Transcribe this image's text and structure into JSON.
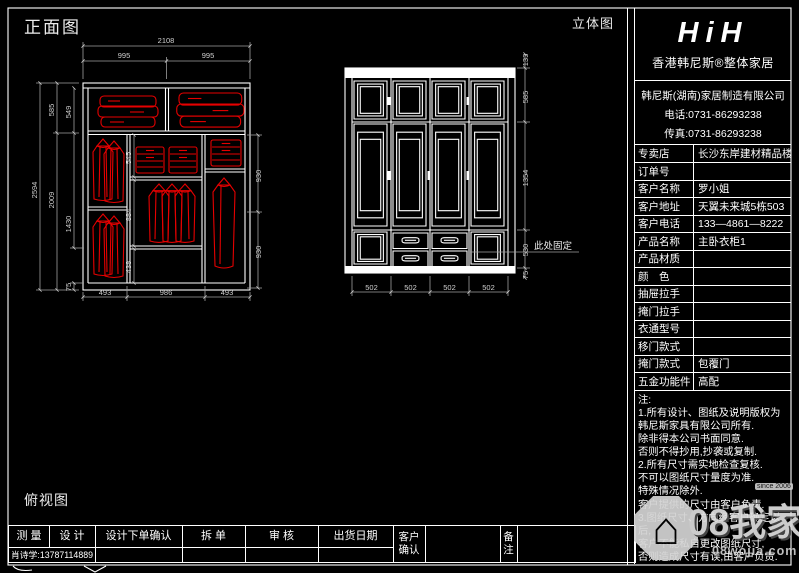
{
  "labels": {
    "front_view": "正面图",
    "perspective_view": "立体图",
    "top_view": "俯视图",
    "fixed_here": "此处固定"
  },
  "brand": {
    "logo": "HiH",
    "name": "香港韩尼斯®整体家居",
    "company": "韩尼斯(湖南)家居制造有限公司",
    "tel": "电话:0731-86293238",
    "fax": "传真:0731-86293238"
  },
  "order": {
    "rows": [
      {
        "label": "专卖店",
        "value": "长沙东岸建材精品楼三楼"
      },
      {
        "label": "订单号",
        "value": ""
      },
      {
        "label": "客户名称",
        "value": "罗小姐"
      },
      {
        "label": "客户地址",
        "value": "天翼未来城5栋503"
      },
      {
        "label": "客户电话",
        "value": "133—4861—8222"
      },
      {
        "label": "产品名称",
        "value": "主卧衣柜1"
      },
      {
        "label": "产品材质",
        "value": ""
      },
      {
        "label": "颜　色",
        "value": ""
      },
      {
        "label": "抽屉拉手",
        "value": ""
      },
      {
        "label": "掩门拉手",
        "value": ""
      },
      {
        "label": "衣通型号",
        "value": ""
      },
      {
        "label": "移门款式",
        "value": ""
      },
      {
        "label": "掩门款式",
        "value": "包覆门"
      },
      {
        "label": "五金功能件",
        "value": "高配"
      }
    ]
  },
  "notes": {
    "title": "注:",
    "lines": [
      "1.所有设计、图纸及说明版权为",
      "韩尼斯家具有限公司所有.",
      "除非得本公司书面同意.",
      "否则不得抄用,抄袭或复制.",
      "2.所有尺寸需实地检查复核.",
      "不可以图纸尺寸量度为准.",
      "特殊情况除外.",
      "客户提供的尺寸由客户负责.",
      "3.图纸尺寸、方向经客户确定以后,",
      "客户不能私自更改图纸尺寸,",
      "否则造成尺寸有误,由客户负责."
    ]
  },
  "footer": {
    "headers": [
      "测 量",
      "设 计",
      "设计下单确认",
      "拆 单",
      "审 核",
      "出货日期"
    ],
    "customer_confirm_1": "客户",
    "customer_confirm_2": "确认",
    "remark_1": "备",
    "remark_2": "注",
    "measure_value": "肖诗学:13787114889"
  },
  "front_dims": {
    "top": [
      "2108",
      "995",
      "995"
    ],
    "left": [
      "2594",
      "585",
      "2009",
      "549",
      "1430",
      "75"
    ],
    "right": [
      "930",
      "930"
    ],
    "bottom": [
      "493",
      "986",
      "493"
    ],
    "inner": [
      "545",
      "884",
      "438"
    ]
  },
  "elev_dims": {
    "right": [
      "133",
      "585",
      "1354",
      "530",
      "75"
    ],
    "bottom": [
      "502",
      "502",
      "502",
      "502"
    ]
  },
  "watermark": {
    "since": "since 2006",
    "big": "08我家",
    "site": "08wojia.com",
    "house": "⌂"
  }
}
